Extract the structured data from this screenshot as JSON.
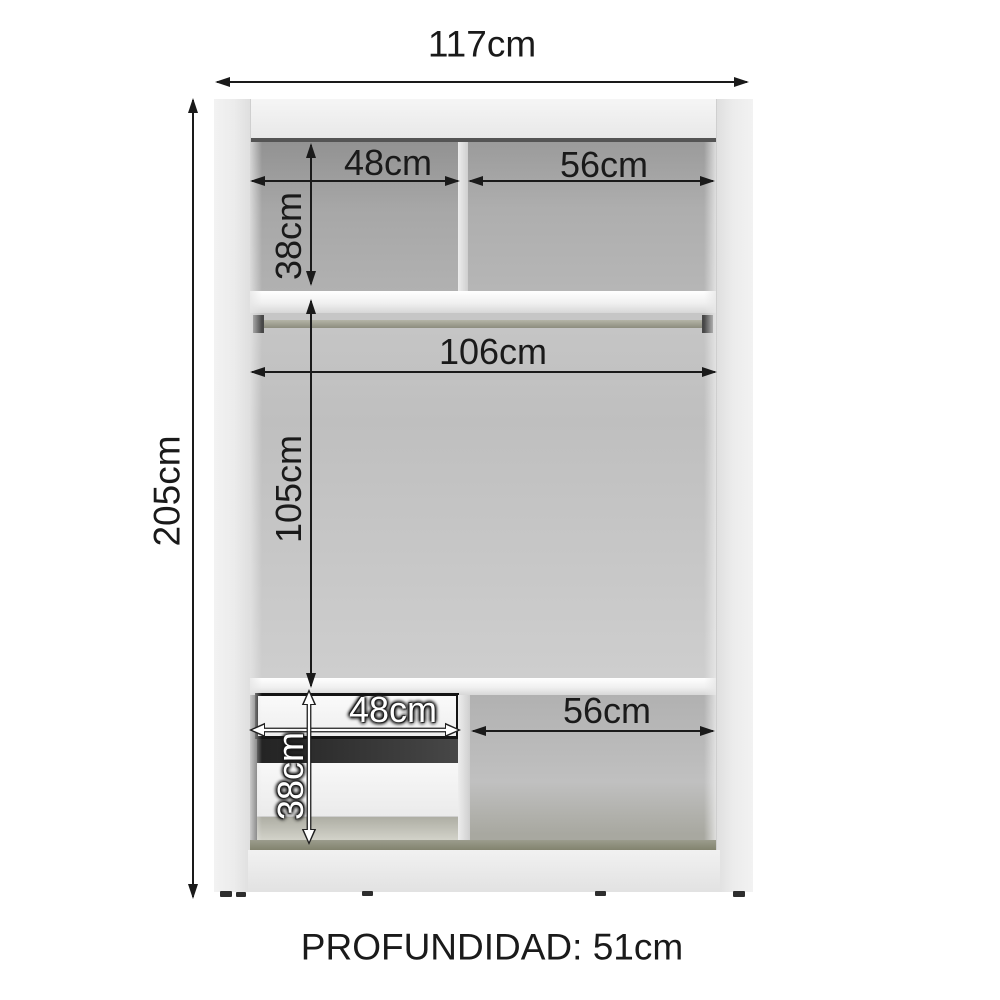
{
  "diagram": {
    "width_label": "117cm",
    "height_label": "205cm",
    "depth_label": "PROFUNDIDAD: 51cm",
    "top_section": {
      "left_shelf_width": "48cm",
      "right_shelf_width": "56cm",
      "shelf_height": "38cm"
    },
    "middle_section": {
      "rod_width": "106cm",
      "compartment_height": "105cm"
    },
    "bottom_section": {
      "drawer_width": "48cm",
      "drawer_height": "38cm",
      "right_compartment_width": "56cm"
    }
  },
  "colors": {
    "dimension_line": "#1a1a1a",
    "white_label": "#ffffff",
    "interior_gray": "#ababab",
    "panel_light": "#efefef",
    "rod": "#9d9d90",
    "drawer_gap_dark": "#3d3d3d",
    "base_strip": "#8f9080"
  }
}
